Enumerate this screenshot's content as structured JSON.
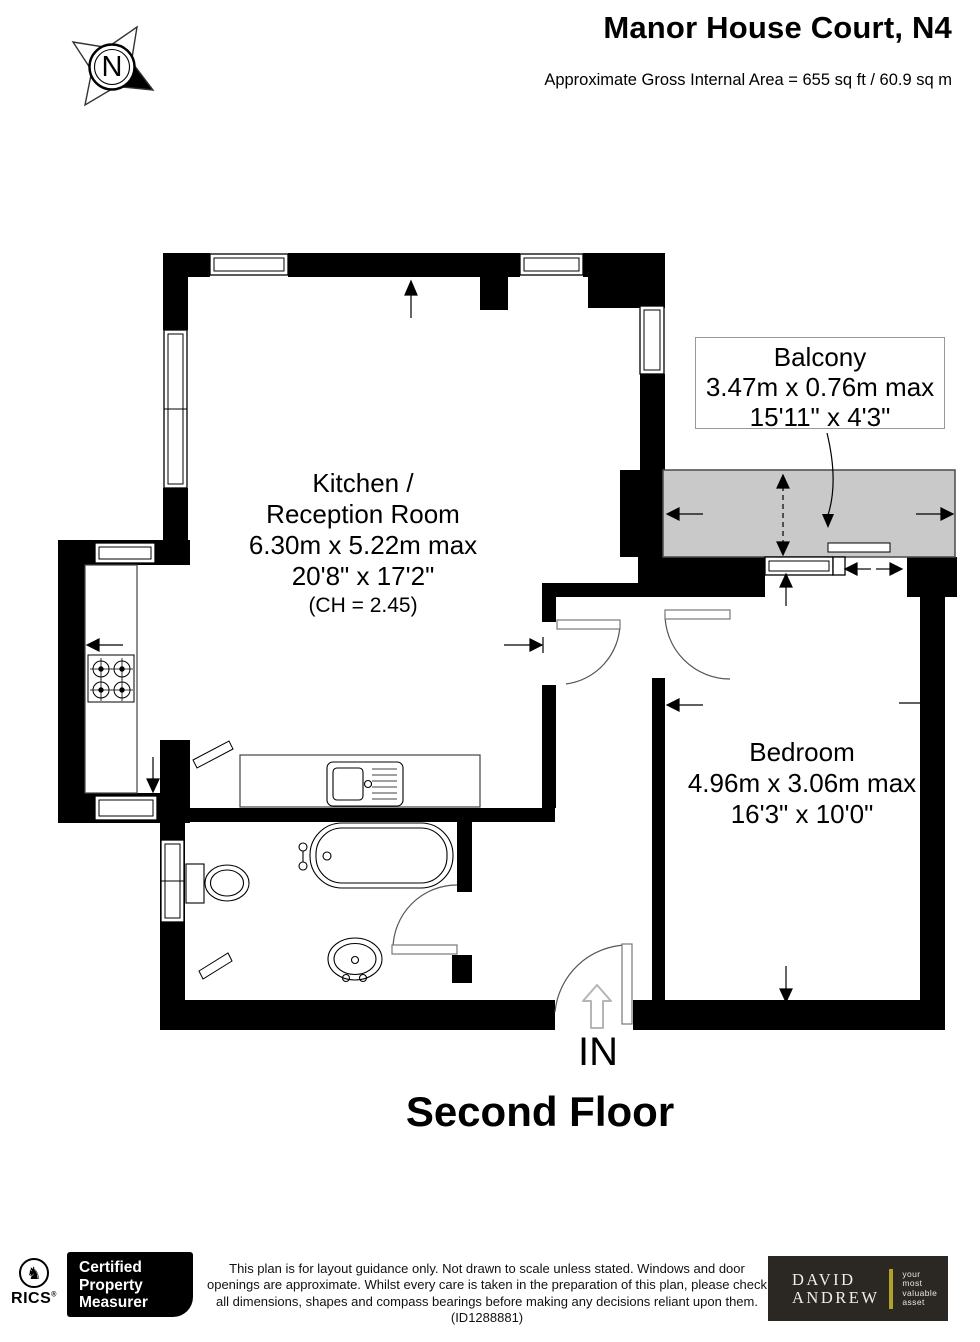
{
  "header": {
    "title": "Manor House Court, N4",
    "area": "Approximate Gross Internal Area =  655 sq ft / 60.9 sq m"
  },
  "compass": {
    "north": "N"
  },
  "plan": {
    "kitchen": {
      "line1": "Kitchen /",
      "line2": "Reception Room",
      "metric": "6.30m x 5.22m max",
      "imperial": "20'8\" x 17'2\"",
      "ceiling": "(CH = 2.45)"
    },
    "balcony": {
      "name": "Balcony",
      "metric": "3.47m x 0.76m max",
      "imperial": "15'11\" x 4'3\""
    },
    "bedroom": {
      "name": "Bedroom",
      "metric": "4.96m x 3.06m max",
      "imperial": "16'3\" x 10'0\""
    },
    "entrance": "IN",
    "floor": "Second Floor"
  },
  "footer": {
    "rics": {
      "name": "RICS",
      "lion_icon": "♞",
      "reg": "®"
    },
    "certified": {
      "line1": "Certified",
      "line2": "Property",
      "line3": "Measurer"
    },
    "disclaimer": "This plan is for layout guidance only. Not drawn to scale unless stated. Windows and door openings are approximate. Whilst every care is taken in the preparation of this plan, please check all dimensions, shapes and compass bearings before making any decisions reliant upon them. (ID1288881)",
    "agency": {
      "line1": "DAVID",
      "line2": "ANDREW",
      "tag1": "your",
      "tag2": "most",
      "tag3": "valuable",
      "tag4": "asset"
    }
  },
  "colors": {
    "wall": "#000000",
    "balcony_fill": "#c9c9c9",
    "plan_line": "#444444",
    "agency_bg": "#2b2723",
    "agency_bar": "#b3a125"
  }
}
